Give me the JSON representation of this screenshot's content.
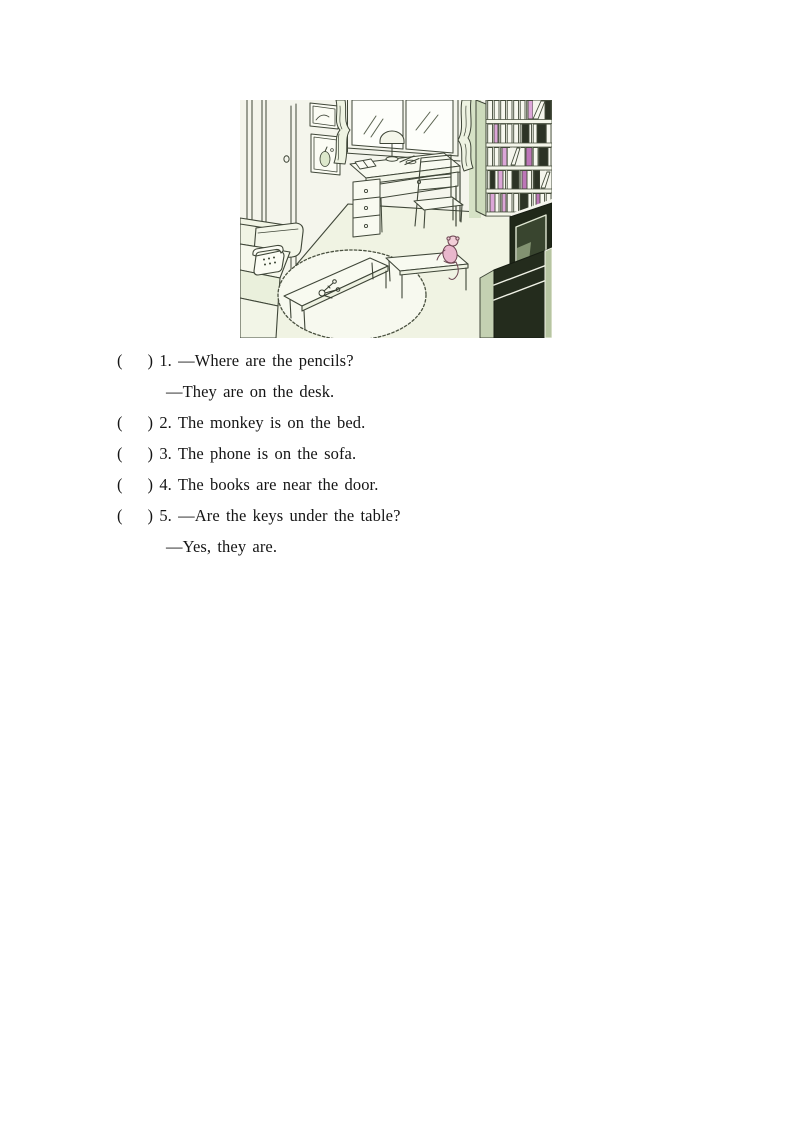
{
  "page": {
    "background": "#ffffff"
  },
  "illustration": {
    "name": "room-scene",
    "objects": [
      "door",
      "picture-frames",
      "window",
      "curtains",
      "desk",
      "desk-lamp",
      "book-on-desk",
      "pencils",
      "chair",
      "bookshelf",
      "books",
      "tv",
      "tv-cabinet",
      "sofa",
      "phone",
      "rug",
      "coffee-table",
      "keys",
      "side-table",
      "monkey"
    ],
    "colors": {
      "paper": "#f4f5ec",
      "ink": "#3f4638",
      "floor": "#f0f3e3",
      "sage": "#cddbbc",
      "pink_book": "#dca6d8",
      "magenta_book": "#bd76b8",
      "dark_book": "#2c3325",
      "tv_dark": "#202819",
      "screen": "#39452f",
      "monkey_pink": "#e9b7cc"
    }
  },
  "questions": {
    "items": [
      {
        "line": "(    ) 1. —Where are the pencils?",
        "answer": "—They are on the desk."
      },
      {
        "line": "(    ) 2. The monkey is on the bed."
      },
      {
        "line": "(    ) 3. The phone is on the sofa."
      },
      {
        "line": "(    ) 4. The books are near the door."
      },
      {
        "line": "(    ) 5. —Are the keys under the table?",
        "answer": "—Yes, they are."
      }
    ]
  }
}
